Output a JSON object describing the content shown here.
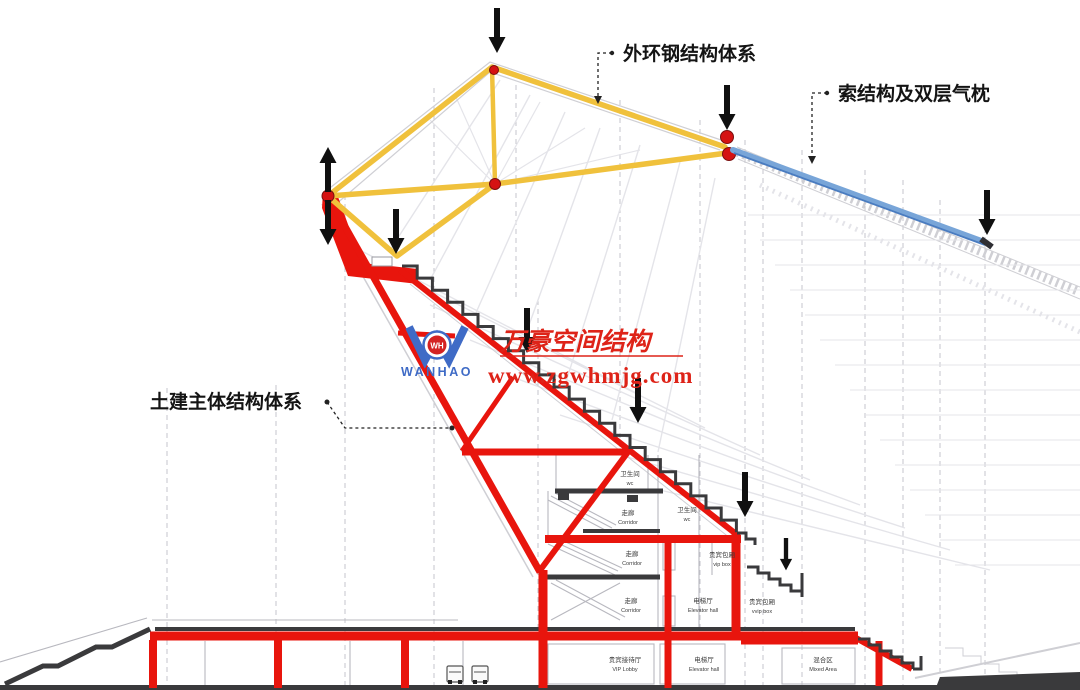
{
  "annotations": {
    "outer_ring_label": "外环钢结构体系",
    "cable_label": "索结构及双层气枕",
    "civil_label": "土建主体结构体系"
  },
  "watermark": {
    "brand_cn": "万豪空间结构",
    "url": "www.zgwhmjg.com",
    "logo_text": "WANHAO",
    "logo_monogram": "WH"
  },
  "rooms": [
    {
      "zh": "卫生间",
      "en": "wc"
    },
    {
      "zh": "走廊",
      "en": "Corridor"
    },
    {
      "zh": "卫生间",
      "en": "wc"
    },
    {
      "zh": "走廊",
      "en": "Corridor"
    },
    {
      "zh": "贵宾包厢",
      "en": "vip box"
    },
    {
      "zh": "走廊",
      "en": "Corridor"
    },
    {
      "zh": "电梯厅",
      "en": "Elevator hall"
    },
    {
      "zh": "贵宾包厢",
      "en": "vvip box"
    },
    {
      "zh": "贵宾接待厅",
      "en": "VIP Lobby"
    },
    {
      "zh": "电梯厅",
      "en": "Elevator hall"
    },
    {
      "zh": "混合区",
      "en": "Mixed Area"
    }
  ],
  "icons": {
    "load_arrow_down": "downward point-load arrow",
    "load_arrow_up": "upward reaction arrow"
  },
  "colors": {
    "structure-red": "#e8150d",
    "steel-yellow": "#f0c13c",
    "cable-blue": "#78a5d8",
    "cable-blue-dark": "#4a7cc0",
    "node-red": "#d51212",
    "watermark-red": "#de2318",
    "logo-blue": "#3f6bc6",
    "ink": "#141414",
    "slab-dark": "#3a3a3c",
    "arrow-black": "#101010"
  }
}
